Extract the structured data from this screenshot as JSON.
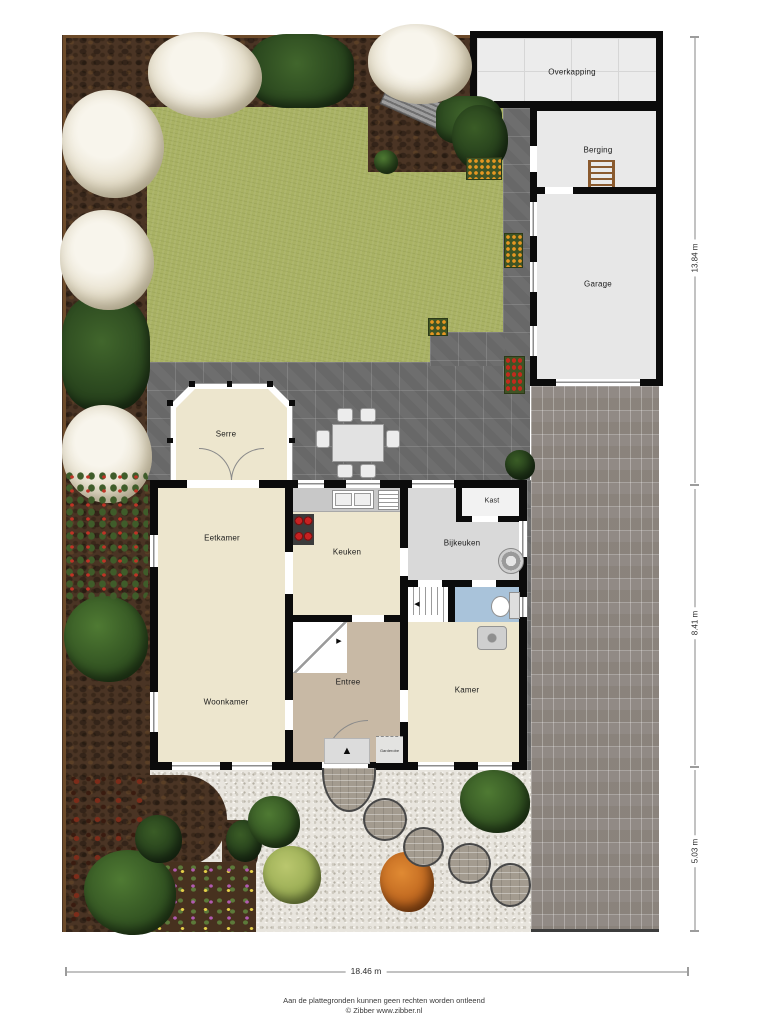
{
  "rooms": {
    "overkapping": "Overkapping",
    "berging": "Berging",
    "garage": "Garage",
    "serre": "Serre",
    "eetkamer": "Eetkamer",
    "keuken": "Keuken",
    "bijkeuken": "Bijkeuken",
    "kast": "Kast",
    "woonkamer": "Woonkamer",
    "entree": "Entree",
    "kamer": "Kamer",
    "garderobe": "Garderobe"
  },
  "dimensions": {
    "right_top": "13.84 m",
    "right_middle": "8.41 m",
    "right_bottom": "5.03 m",
    "bottom": "18.46 m"
  },
  "icons": {
    "door_mat_arrow": "▲",
    "stairs_arrow_right": "▶",
    "stairs_arrow_left": "◀"
  },
  "footer": {
    "disclaimer": "Aan de plattegronden kunnen geen rechten worden ontleend",
    "credit": "© Zibber www.zibber.nl"
  },
  "colors": {
    "wall": "#0b0b0b",
    "lawn": "#a9b264",
    "patio_tile": "#6e6e6e",
    "soil": "#4a3424",
    "gravel": "#e8e5de",
    "driveway": "#97908a",
    "room_beige": "#ede6ce",
    "entree_tan": "#c8b9a5",
    "utility_grey": "#d9d9d9",
    "toilet_blue": "#a9c3da",
    "garage_floor": "#e7e7e7",
    "burner_red": "#c82121",
    "blossom": "#efe9db",
    "shrub_green": "#3a5c26",
    "accent_orange": "#d97e2c"
  }
}
